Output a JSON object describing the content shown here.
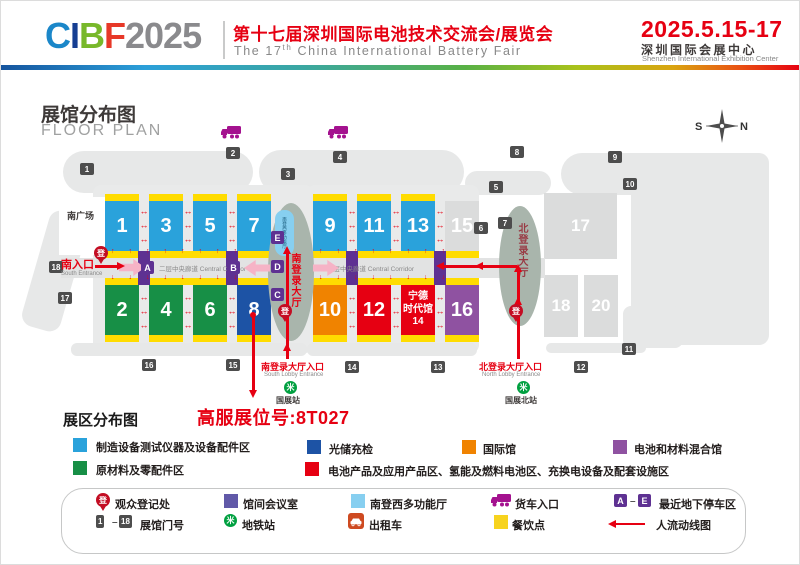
{
  "header": {
    "logo": {
      "letters": [
        {
          "ch": "C",
          "color": "#1B87C9"
        },
        {
          "ch": "I",
          "color": "#163E92"
        },
        {
          "ch": "B",
          "color": "#78B82A"
        },
        {
          "ch": "F",
          "color": "#E73828"
        }
      ],
      "year": "2025",
      "year_color": "#8A8A8D"
    },
    "title_cn": "第十七届深圳国际电池技术交流会/展览会",
    "title_en": {
      "pre": "The 17",
      "sup": "th",
      "post": " China International Battery Fair"
    },
    "dates": "2025.5.15-17",
    "venue_cn": "深圳国际会展中心",
    "venue_en": "Shenzhen International Exhibition Center"
  },
  "section": {
    "title_cn": "展馆分布图",
    "title_en": "FLOOR PLAN"
  },
  "map": {
    "compass": {
      "s": "S",
      "n": "N"
    },
    "south_plaza": "南广场",
    "corridor_label": "二层中央廊道 Central Corridor",
    "south_entrance": {
      "cn": "南入口",
      "en": "South Entrance"
    },
    "south_lobby_entrance": {
      "cn": "南登录大厅入口",
      "en": "South Lobby Entrance"
    },
    "north_lobby_entrance": {
      "cn": "北登录大厅入口",
      "en": "North Lobby Entrance"
    },
    "south_lobby": "南登录大厅",
    "north_lobby": "北登录大厅",
    "multi_hall": "南登西多功能厅",
    "metro_south": "国展站",
    "metro_north": "国展北站",
    "metro_glyph": "米",
    "reg_glyph": "登",
    "letters": {
      "a": "A",
      "b": "B",
      "c": "C",
      "d": "D",
      "e": "E"
    },
    "gates": [
      "1",
      "2",
      "3",
      "4",
      "5",
      "6",
      "7",
      "8",
      "9",
      "10",
      "11",
      "12",
      "13",
      "14",
      "15",
      "16",
      "17",
      "18"
    ],
    "halls": {
      "h1": "1",
      "h2": "2",
      "h3": "3",
      "h4": "4",
      "h5": "5",
      "h6": "6",
      "h7": "7",
      "h8": "8",
      "h9": "9",
      "h10": "10",
      "h11": "11",
      "h12": "12",
      "h13": "13",
      "h15": "15",
      "h16": "16",
      "h17": "17",
      "h18": "18",
      "h20": "20"
    },
    "hall14": {
      "l1": "宁德",
      "l2": "时代馆",
      "l3": "14"
    },
    "hall_colors": {
      "equipment_blue": "#2AA2DB",
      "materials_green": "#178F46",
      "storage_navy": "#1D53A5",
      "international_orange": "#F08300",
      "battery_red": "#E60012",
      "mixed_purple": "#8F52A1"
    },
    "arrows": {
      "up_row": "↑↑↑↑↑↑↑↑",
      "down_row": "↓↓↓↓↓↓↓↓",
      "aisle": "↔\n↔\n↔"
    }
  },
  "booth_callout": "高服展位号:8T027",
  "zone_legend": {
    "title": "展区分布图",
    "items": [
      {
        "label": "制造设备测试仪器及设备配件区",
        "color": "#2AA2DB"
      },
      {
        "label": "光储充检",
        "color": "#1D53A5"
      },
      {
        "label": "国际馆",
        "color": "#F08300"
      },
      {
        "label": "电池和材料混合馆",
        "color": "#8F52A1"
      },
      {
        "label": "原材料及零配件区",
        "color": "#178F46"
      },
      {
        "label": "电池产品及应用产品区、氢能及燃料电池区、充换电设备及配套设施区",
        "color": "#E60012"
      }
    ]
  },
  "facility_legend": {
    "reg_label": "观众登记处",
    "meeting_label": "馆间会议室",
    "meeting_color": "#6159A8",
    "multi_label": "南登西多功能厅",
    "multi_color": "#87CFF0",
    "truck_label": "货车入口",
    "parking_a": "A",
    "parking_e": "E",
    "parking_dash": "–",
    "parking_label": "最近地下停车区",
    "range_from": "1",
    "range_to": "18",
    "range_dash": "–",
    "range_label": "展馆门号",
    "metro_label": "地铁站",
    "taxi_label": "出租车",
    "dining_label": "餐饮点",
    "dining_color": "#F7D31E",
    "flow_label": "人流动线图"
  }
}
